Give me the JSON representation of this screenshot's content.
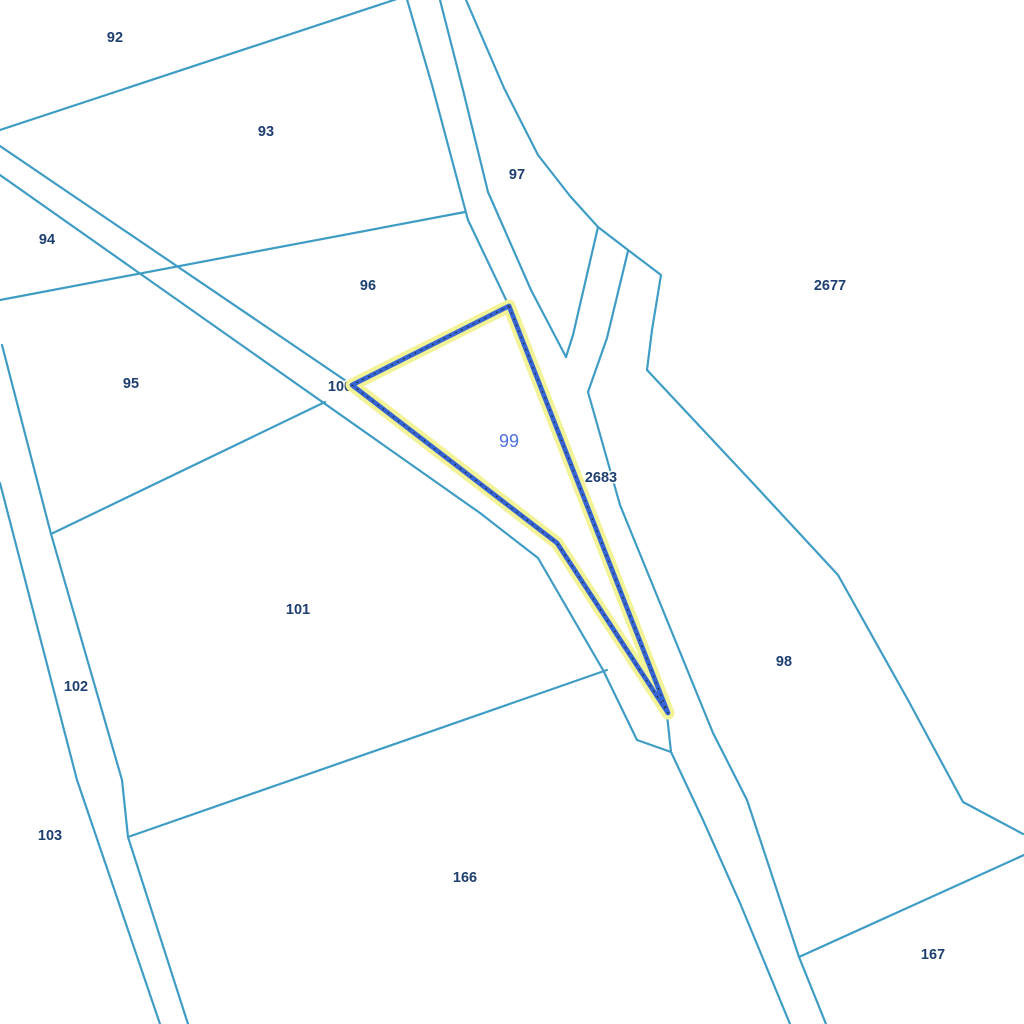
{
  "map": {
    "background_color": "#ffffff",
    "boundary_color": "#3f9dc5",
    "boundary_width": 2.2,
    "label_color": "#1e3f70",
    "selected_parcel": {
      "id": "99",
      "label": "99",
      "label_x": 509,
      "label_y": 442,
      "label_color": "#4e71de",
      "halo_color": "#f2f296",
      "halo_width": 13,
      "stroke_color": "#3565d5",
      "stroke_width": 4.8,
      "dot_color": "#2a2a2a",
      "polygon": [
        [
          509,
          306
        ],
        [
          352,
          385
        ],
        [
          557,
          543
        ],
        [
          668,
          713
        ]
      ]
    },
    "boundaries": [
      {
        "name": "boundary-92-93",
        "points": [
          [
            0,
            130
          ],
          [
            406,
            -4
          ]
        ]
      },
      {
        "name": "road-west-edge",
        "points": [
          [
            406,
            -4
          ],
          [
            432,
            85
          ],
          [
            468,
            220
          ],
          [
            509,
            306
          ]
        ]
      },
      {
        "name": "road-mid-edge",
        "points": [
          [
            440,
            0
          ],
          [
            463,
            90
          ],
          [
            488,
            192
          ],
          [
            531,
            290
          ],
          [
            566,
            357
          ]
        ]
      },
      {
        "name": "v-branch-east",
        "points": [
          [
            598,
            227
          ],
          [
            573,
            335
          ],
          [
            566,
            357
          ]
        ]
      },
      {
        "name": "east-curve-2677",
        "points": [
          [
            466,
            0
          ],
          [
            504,
            88
          ],
          [
            538,
            155
          ],
          [
            570,
            196
          ],
          [
            598,
            227
          ],
          [
            628,
            250
          ],
          [
            661,
            275
          ],
          [
            652,
            330
          ],
          [
            647,
            370
          ],
          [
            750,
            480
          ],
          [
            838,
            575
          ],
          [
            908,
            700
          ],
          [
            963,
            802
          ],
          [
            1023,
            834
          ]
        ]
      },
      {
        "name": "sliver-east-edge",
        "points": [
          [
            628,
            251
          ],
          [
            607,
            338
          ],
          [
            588,
            392
          ],
          [
            620,
            505
          ],
          [
            713,
            733
          ],
          [
            747,
            800
          ],
          [
            799,
            957
          ],
          [
            826,
            1024
          ]
        ]
      },
      {
        "name": "boundary-98-167",
        "points": [
          [
            799,
            957
          ],
          [
            1024,
            855
          ]
        ]
      },
      {
        "name": "boundary-93-96",
        "points": [
          [
            0,
            300
          ],
          [
            465,
            212
          ]
        ]
      },
      {
        "name": "road100-north-edge",
        "points": [
          [
            0,
            146
          ],
          [
            352,
            385
          ]
        ]
      },
      {
        "name": "road100-south-edge",
        "points": [
          [
            0,
            175
          ],
          [
            480,
            513
          ],
          [
            538,
            558
          ],
          [
            603,
            670
          ],
          [
            637,
            740
          ],
          [
            671,
            752
          ],
          [
            703,
            820
          ],
          [
            740,
            903
          ],
          [
            790,
            1024
          ]
        ]
      },
      {
        "name": "parcel99-tip-stub",
        "points": [
          [
            667,
            715
          ],
          [
            671,
            752
          ]
        ]
      },
      {
        "name": "boundary-95-101",
        "points": [
          [
            51,
            534
          ],
          [
            325,
            402
          ]
        ]
      },
      {
        "name": "road102-east-edge",
        "points": [
          [
            2,
            345
          ],
          [
            51,
            534
          ],
          [
            122,
            780
          ],
          [
            128,
            837
          ],
          [
            188,
            1024
          ]
        ]
      },
      {
        "name": "road102-west-edge",
        "points": [
          [
            0,
            483
          ],
          [
            77,
            780
          ],
          [
            160,
            1024
          ]
        ]
      },
      {
        "name": "boundary-101-166",
        "points": [
          [
            128,
            837
          ],
          [
            607,
            670
          ]
        ]
      }
    ],
    "labels": [
      {
        "id": "92",
        "text": "92",
        "x": 115,
        "y": 38
      },
      {
        "id": "93",
        "text": "93",
        "x": 266,
        "y": 132
      },
      {
        "id": "94",
        "text": "94",
        "x": 47,
        "y": 240
      },
      {
        "id": "95",
        "text": "95",
        "x": 131,
        "y": 384
      },
      {
        "id": "96",
        "text": "96",
        "x": 368,
        "y": 286
      },
      {
        "id": "97",
        "text": "97",
        "x": 517,
        "y": 175
      },
      {
        "id": "100",
        "text": "100",
        "x": 340,
        "y": 387
      },
      {
        "id": "2677",
        "text": "2677",
        "x": 830,
        "y": 286
      },
      {
        "id": "2683",
        "text": "2683",
        "x": 601,
        "y": 478
      },
      {
        "id": "101",
        "text": "101",
        "x": 298,
        "y": 610
      },
      {
        "id": "98",
        "text": "98",
        "x": 784,
        "y": 662
      },
      {
        "id": "102",
        "text": "102",
        "x": 76,
        "y": 687
      },
      {
        "id": "103",
        "text": "103",
        "x": 50,
        "y": 836
      },
      {
        "id": "166",
        "text": "166",
        "x": 465,
        "y": 878
      },
      {
        "id": "167",
        "text": "167",
        "x": 933,
        "y": 955
      }
    ]
  }
}
